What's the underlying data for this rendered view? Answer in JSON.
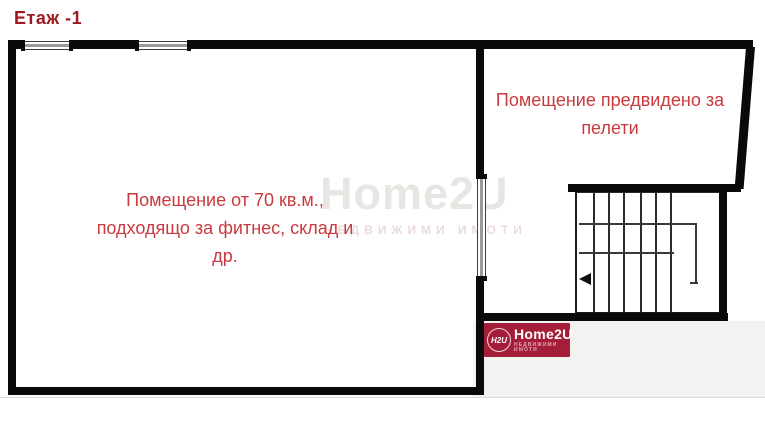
{
  "title": "Етаж -1",
  "rooms": {
    "main": {
      "line1": "Помещение от 70 кв.м.,",
      "line2": "подходящо за фитнес, склад и",
      "line3": "др."
    },
    "pellets": {
      "line1": "Помещение предвидено за",
      "line2": "пелети"
    }
  },
  "watermark": {
    "brand": "Home2U",
    "subtitle": "НЕДВИЖИМИ ИМОТИ"
  },
  "logo": {
    "mark": "H2U",
    "brand": "Home2U",
    "subtitle": "НЕДВИЖИМИ ИМОТИ"
  },
  "stairs": {
    "direction_arrow": "left"
  },
  "colors": {
    "wall": "#0a0a0a",
    "title_red": "#9e1a1e",
    "label_red": "#c93a3e",
    "logo_background": "#a51e39",
    "watermark_gray": "#e8e6e3",
    "footer_band": "#f4f2f0"
  }
}
